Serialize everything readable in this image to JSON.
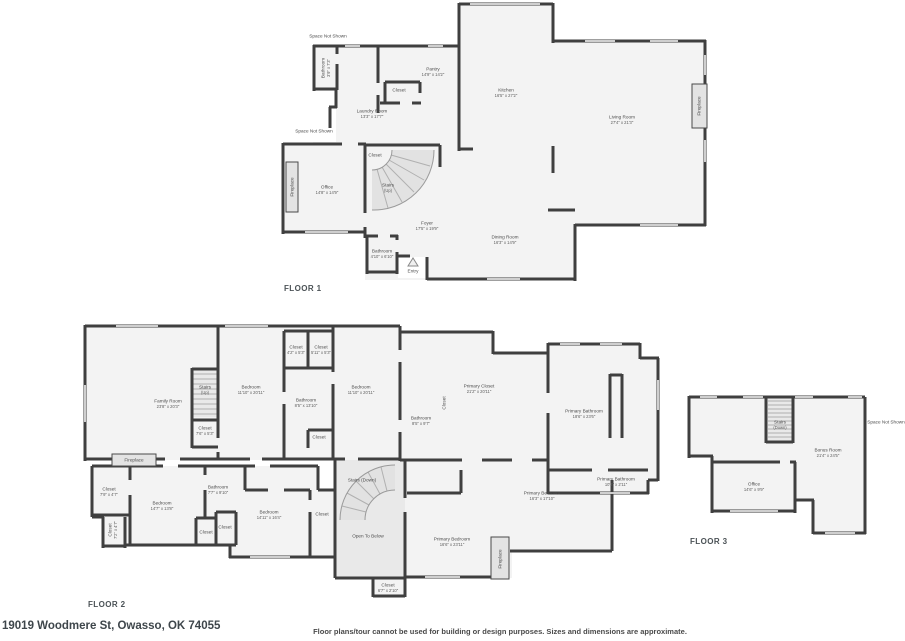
{
  "meta": {
    "address": "19019 Woodmere St, Owasso, OK 74055",
    "disclaimer": "Floor plans/tour cannot be used for building or design purposes. Sizes and dimensions are approximate."
  },
  "floors": [
    {
      "id": "floor1",
      "label": "FLOOR 1",
      "rooms": [
        {
          "name": "Space Not Shown",
          "x": 328,
          "y": 36
        },
        {
          "name": "Bathroom",
          "dims": "3'9\" x 7'3\"",
          "x": 326,
          "y": 68,
          "rot": 1
        },
        {
          "name": "Laundry Room",
          "dims": "13'3\" x 17'7\"",
          "x": 372,
          "y": 114
        },
        {
          "name": "Pantry",
          "dims": "14'9\" x 14'2\"",
          "x": 433,
          "y": 72
        },
        {
          "name": "Closet",
          "x": 399,
          "y": 90
        },
        {
          "name": "Kitchen",
          "dims": "16'5\" x 27'2\"",
          "x": 506,
          "y": 93
        },
        {
          "name": "Living Room",
          "dims": "27'4\" x 21'3\"",
          "x": 622,
          "y": 120
        },
        {
          "name": "Fireplace",
          "x": 699,
          "y": 106,
          "rot": 1
        },
        {
          "name": "Space Not Shown",
          "x": 314,
          "y": 131
        },
        {
          "name": "Office",
          "dims": "14'8\" x 14'9\"",
          "x": 327,
          "y": 190
        },
        {
          "name": "Fireplace",
          "x": 292,
          "y": 187,
          "rot": 1
        },
        {
          "name": "Closet",
          "x": 375,
          "y": 155
        },
        {
          "name": "Stairs",
          "dims": "(Up)",
          "x": 388,
          "y": 188
        },
        {
          "name": "Foyer",
          "dims": "17'5\" x 19'9\"",
          "x": 427,
          "y": 226
        },
        {
          "name": "Bathroom",
          "dims": "4'10\" x 6'10\"",
          "x": 382,
          "y": 254
        },
        {
          "name": "Entry",
          "x": 413,
          "y": 271
        },
        {
          "name": "Dining Room",
          "dims": "16'3\" x 14'9\"",
          "x": 505,
          "y": 240
        }
      ]
    },
    {
      "id": "floor2",
      "label": "FLOOR 2",
      "rooms": [
        {
          "name": "Family Room",
          "dims": "23'8\" x 20'3\"",
          "x": 168,
          "y": 404
        },
        {
          "name": "Stairs",
          "dims": "(Up)",
          "x": 205,
          "y": 390
        },
        {
          "name": "Closet",
          "dims": "7'6\" x 5'3\"",
          "x": 205,
          "y": 431
        },
        {
          "name": "Bedroom",
          "dims": "11'10\" x 20'11\"",
          "x": 251,
          "y": 390
        },
        {
          "name": "Closet",
          "dims": "4'2\" x 5'3\"",
          "x": 296,
          "y": 350
        },
        {
          "name": "Closet",
          "dims": "5'11\" x 5'3\"",
          "x": 321,
          "y": 350
        },
        {
          "name": "Bathroom",
          "dims": "8'5\" x 13'10\"",
          "x": 306,
          "y": 403
        },
        {
          "name": "Closet",
          "x": 319,
          "y": 437
        },
        {
          "name": "Bedroom",
          "dims": "11'10\" x 20'11\"",
          "x": 361,
          "y": 390
        },
        {
          "name": "Closet",
          "x": 444,
          "y": 403,
          "rot": 1
        },
        {
          "name": "Bathroom",
          "dims": "8'5\" x 9'7\"",
          "x": 421,
          "y": 421
        },
        {
          "name": "Primary Closet",
          "dims": "21'2\" x 20'11\"",
          "x": 479,
          "y": 389
        },
        {
          "name": "Primary Bathroom",
          "dims": "18'6\" x 23'6\"",
          "x": 584,
          "y": 414
        },
        {
          "name": "Primary Bathroom",
          "dims": "10'4\" x 2'11\"",
          "x": 616,
          "y": 482
        },
        {
          "name": "Primary Bedroom",
          "dims": "16'3\" x 17'10\"",
          "x": 542,
          "y": 496
        },
        {
          "name": "Fireplace",
          "x": 134,
          "y": 460
        },
        {
          "name": "Closet",
          "dims": "7'9\" x 4'7\"",
          "x": 109,
          "y": 492
        },
        {
          "name": "Closet",
          "dims": "7'2\" x 4'7\"",
          "x": 113,
          "y": 530,
          "rot": 1
        },
        {
          "name": "Bedroom",
          "dims": "14'7\" x 13'8\"",
          "x": 162,
          "y": 506
        },
        {
          "name": "Bathroom",
          "dims": "7'7\" x 9'10\"",
          "x": 218,
          "y": 490
        },
        {
          "name": "Closet",
          "x": 206,
          "y": 532
        },
        {
          "name": "Closet",
          "x": 225,
          "y": 527
        },
        {
          "name": "Bedroom",
          "dims": "14'11\" x 16'4\"",
          "x": 269,
          "y": 515
        },
        {
          "name": "Closet",
          "x": 322,
          "y": 514
        },
        {
          "name": "Stairs (Down)",
          "x": 362,
          "y": 480
        },
        {
          "name": "Open To Below",
          "x": 368,
          "y": 536
        },
        {
          "name": "Closet",
          "dims": "6'7\" x 2'10\"",
          "x": 388,
          "y": 588
        },
        {
          "name": "Primary Bedroom",
          "dims": "16'6\" x 23'11\"",
          "x": 452,
          "y": 542
        },
        {
          "name": "Fireplace",
          "x": 500,
          "y": 559,
          "rot": 1
        }
      ]
    },
    {
      "id": "floor3",
      "label": "FLOOR 3",
      "rooms": [
        {
          "name": "Stairs",
          "dims": "(Down)",
          "x": 780,
          "y": 425
        },
        {
          "name": "Space Not Shown",
          "x": 886,
          "y": 422
        },
        {
          "name": "Bonus Room",
          "dims": "21'4\" x 24'5\"",
          "x": 828,
          "y": 453
        },
        {
          "name": "Office",
          "dims": "14'6\" x 9'9\"",
          "x": 754,
          "y": 487
        }
      ]
    }
  ]
}
